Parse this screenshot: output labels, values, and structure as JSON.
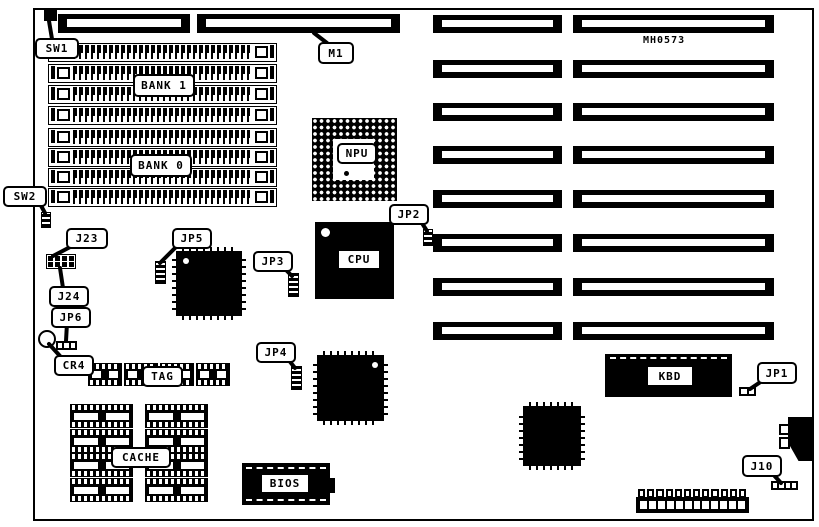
{
  "colors": {
    "ink": "#000000",
    "paper": "#ffffff"
  },
  "board": {
    "marking": "MH0573",
    "memory": {
      "bank1_label": "BANK 1",
      "bank0_label": "BANK 0",
      "rows_per_bank": 4
    },
    "expansion_slots": {
      "rows": 8,
      "slots_per_row": 2
    },
    "cache": {
      "label": "CACHE",
      "chips": 8
    },
    "tag": {
      "label": "TAG",
      "chips": 4
    },
    "power_connector": {
      "positions": 12
    }
  },
  "labels": {
    "sw1": "SW1",
    "sw2": "SW2",
    "m1": "M1",
    "bank1": "BANK 1",
    "bank0": "BANK 0",
    "j23": "J23",
    "j24": "J24",
    "jp6": "JP6",
    "cr4": "CR4",
    "jp5": "JP5",
    "jp3": "JP3",
    "jp2": "JP2",
    "jp4": "JP4",
    "jp1": "JP1",
    "j10": "J10",
    "npu": "NPU",
    "cpu": "CPU",
    "tag": "TAG",
    "cache": "CACHE",
    "bios": "BIOS",
    "kbd": "KBD"
  }
}
